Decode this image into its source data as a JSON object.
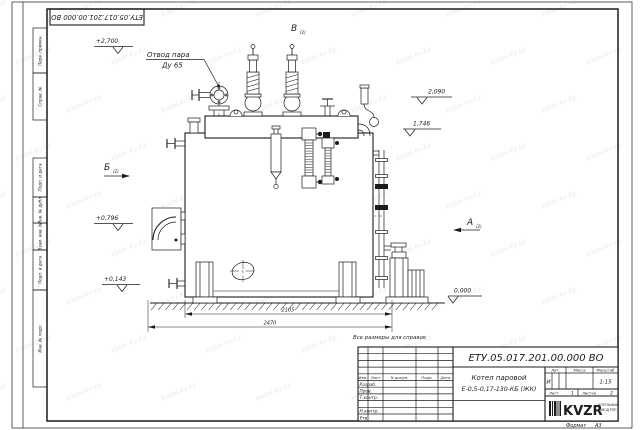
{
  "watermark": {
    "text": "kotel-kv.kz"
  },
  "doc": {
    "number": "ЕТУ.05.017.201.00.000  ВО",
    "note": "Все размеры для справок",
    "format_label": "Формат",
    "format": "А3"
  },
  "margin_fields": {
    "perv": "Перв. примен.",
    "sprav": "Справ. №",
    "podp1": "Подп. и дата",
    "inv_dubl": "Инв. № дубл.",
    "vzam": "Взам. инв. №",
    "podp2": "Подп. и дата",
    "inv_podl": "Инв. № подл."
  },
  "annotations": {
    "steam_outlet_1": "Отвод пара",
    "steam_outlet_2": "Ду 65",
    "elev_2700": "+2,700",
    "elev_2090": "2,090",
    "elev_1746": "1,746",
    "elev_0796": "+0,796",
    "elev_0143": "+0,143",
    "elev_0000": "0,000",
    "view_a": "А",
    "view_b": "Б",
    "view_v": "В",
    "view_sub": "(2)",
    "dim_2105": "2105",
    "dim_2470": "2470"
  },
  "stamp": {
    "doc_number": "ЕТУ.05.017.201.00.000  ВО",
    "title_line1": "Котел паровой",
    "title_line2": "Е-0,5-0,17-130-КБ (ЖК)",
    "col_izm": "Изм.",
    "col_list": "Лист",
    "col_ndoc": "N докум.",
    "col_podp": "Подп.",
    "col_data": "Дата",
    "row_razrab": "Разраб.",
    "row_prov": "Пров.",
    "row_tkontr": "Т.контр.",
    "row_nkontr": "Н.контр.",
    "row_utv": "Утв.",
    "lit_label": "Лит.",
    "massa_label": "Масса",
    "masshtab_label": "Масштаб",
    "lit_value": "И",
    "scale_value": "1:15",
    "list_label": "Лист",
    "list_no": "1",
    "listov_label": "Листов",
    "listov_no": "2",
    "logo": "KVZR",
    "logo_sub1": "КОТЕЛЬНЫЙ",
    "logo_sub2": "ЗАВОД РЭП"
  }
}
